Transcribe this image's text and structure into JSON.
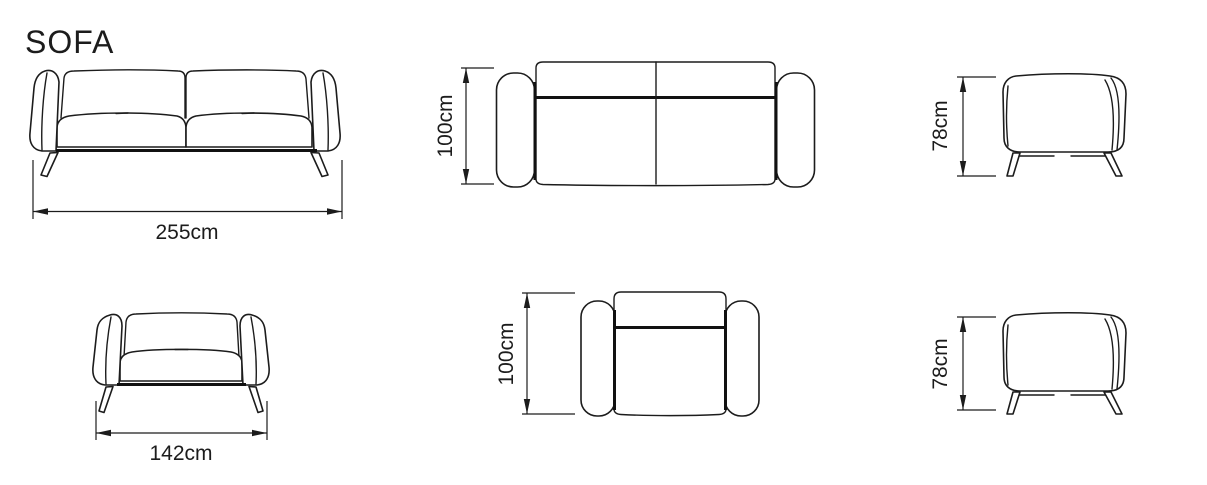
{
  "title": "SOFA",
  "colors": {
    "line": "#1c1c1c",
    "background": "#ffffff"
  },
  "views": {
    "sofa_front": {
      "name": "sofa front elevation",
      "label": "255cm"
    },
    "sofa_top": {
      "name": "sofa plan view",
      "label": "100cm"
    },
    "sofa_side": {
      "name": "sofa side elevation",
      "label": "78cm"
    },
    "armchair_front": {
      "name": "armchair front elevation",
      "label": "142cm"
    },
    "armchair_top": {
      "name": "armchair plan view",
      "label": "100cm"
    },
    "armchair_side": {
      "name": "armchair side elevation",
      "label": "78cm"
    }
  }
}
